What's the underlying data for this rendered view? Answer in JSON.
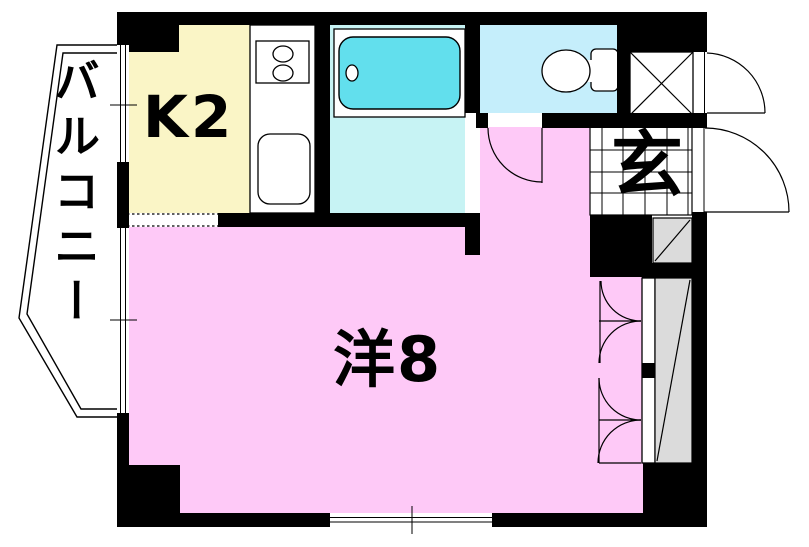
{
  "floorplan": {
    "labels": {
      "balcony": "バルコニー",
      "kitchen": "K2",
      "main_room": "洋8",
      "entrance": "玄"
    },
    "colors": {
      "kitchen": "#faf5c6",
      "main_room": "#fec9f7",
      "bathroom_floor": "#c7f3f4",
      "bathtub": "#62dfed",
      "toilet_room": "#c5eefb",
      "closet": "#dbdbdb",
      "wall": "#000000",
      "background": "#ffffff"
    }
  }
}
